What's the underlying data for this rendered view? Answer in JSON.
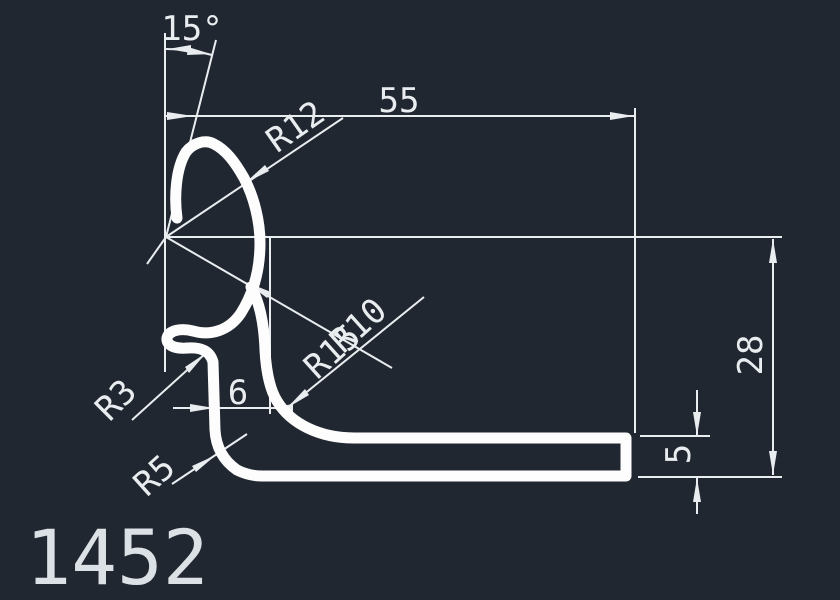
{
  "drawing": {
    "part_number": "1452",
    "background_color": "#212731",
    "line_color": "#e9edf0",
    "profile_color": "#fdfdfe",
    "labels": {
      "angle": "15°",
      "overall_width": "55",
      "overall_height": "28",
      "base_thickness": "5",
      "leg_offset": "6",
      "radius_top": "R12",
      "radius_mid": "R15",
      "radius_inner": "R10",
      "radius_bump": "R3",
      "radius_corner": "R5"
    }
  }
}
